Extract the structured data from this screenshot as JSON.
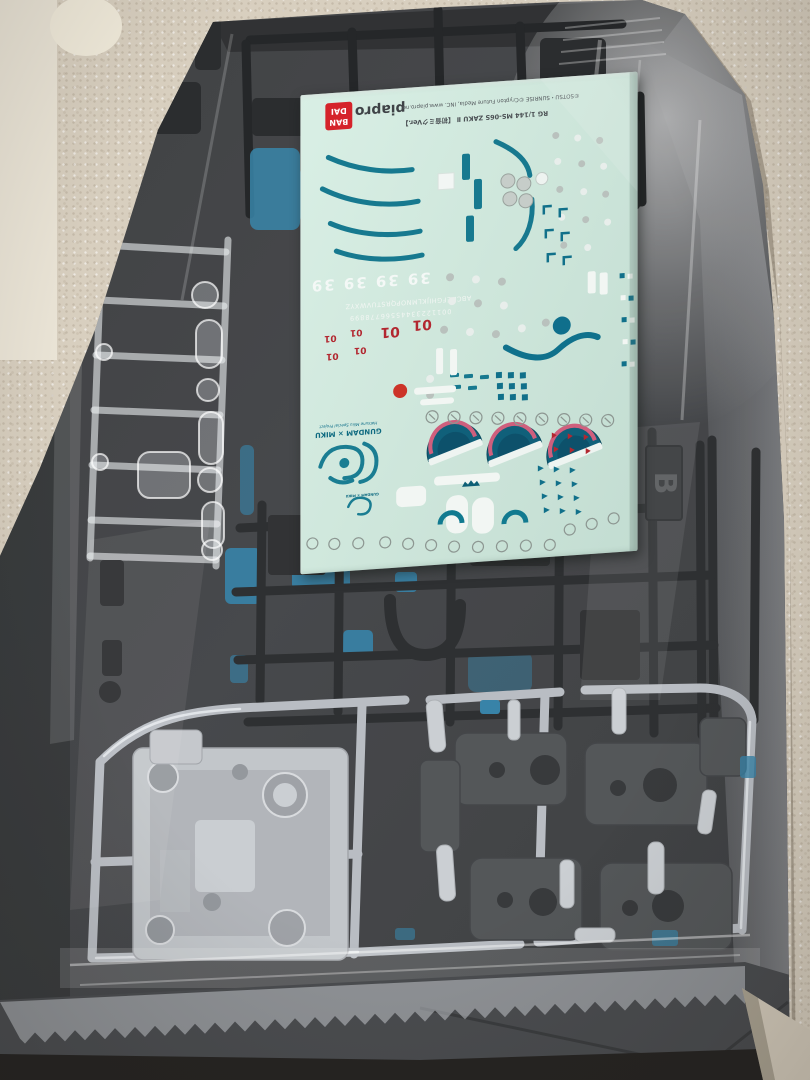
{
  "scene": {
    "subject": "Opened Gunpla kit box with runners and decal sheet inside a plastic bag",
    "colors": {
      "carpet": "#d8cfbf",
      "box_interior": "#3a3c3f",
      "dark_runner": "#1c1e20",
      "silver_runner": "#bfc3c8",
      "clear_runner": "#e8ebee",
      "blue_parts": "#2e7da4",
      "decal_sheet": "#cfe7dc",
      "decal_teal": "#11708a",
      "decal_red": "#b22730",
      "decal_pink": "#cf5f7d",
      "bandai_red": "#d5232a"
    }
  },
  "decal_sheet": {
    "bandai_logo": [
      "BAN",
      "DAI"
    ],
    "piapro_logo": "piapro",
    "credit_line": "©SOTSU・SUNRISE ©Crypton Future Media, INC. www.piapro.net",
    "product_line": "RG 1/144 MS-06S ZAKU Ⅱ 【初音ミクVer.】",
    "miku_numbers": "39 39 39 39",
    "letter_strip": "ABCDEFGHIJKLMNOPQRSTUVWXYZ",
    "digit_strip": "00112233445566778899",
    "unit_number": "01",
    "emblem_subtitle": "Hatsune Miku Special Project",
    "emblem_title": "GUNDAM × MIKU",
    "emblem_title_small": "GUNDAM × MIKU"
  },
  "runners": {
    "tag_letter": "B"
  }
}
